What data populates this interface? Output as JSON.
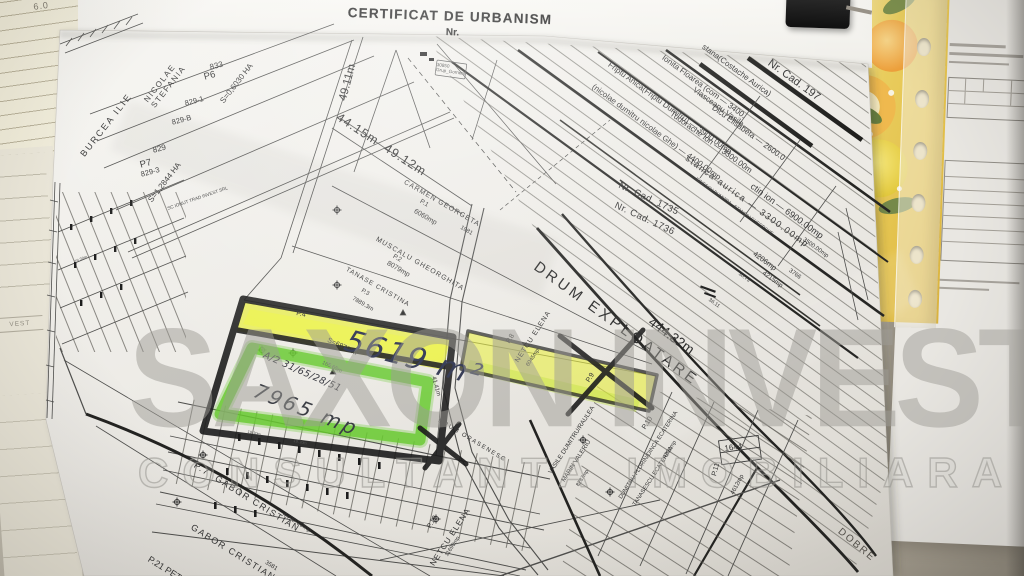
{
  "header": {
    "title": "CERTIFICAT DE URBANISM",
    "number_label": "Nr."
  },
  "watermark": {
    "line1": "SAXON INVEST",
    "line2": "CONSULTANTA IMOBILIARA"
  },
  "desk_notes": {
    "notebook_line1": "10. - 2016",
    "notebook_line2": "6.0",
    "underlay_label": "VEST"
  },
  "handwriting": {
    "area_highlight": "5619 m²",
    "area_parcel": "7965 mp",
    "cad_note": "A/2 31/65/28/51"
  },
  "colors": {
    "highlight_yellow": "#e7ee3b",
    "highlight_green": "#66c92e",
    "marker_black": "#1c1c1c",
    "folder_yellow": "#e6c84e",
    "ink_blue": "#2f3550",
    "paper": "#ece9e3"
  },
  "labels": [
    {
      "t": "NICOLAE\nSTEFANIA"
    },
    {
      "t": "833"
    },
    {
      "t": "P6"
    },
    {
      "t": "S=0,6030 HA"
    },
    {
      "t": "829-1"
    },
    {
      "t": "829-B"
    },
    {
      "t": "BURCEA ILIE"
    },
    {
      "t": "829"
    },
    {
      "t": "P7"
    },
    {
      "t": "829-3"
    },
    {
      "t": "S=1,2844 HA"
    },
    {
      "t": "SC IONUT TRAD INVEST SRL"
    },
    {
      "t": "49.11m"
    },
    {
      "t": "44.15m  49.12m"
    },
    {
      "t": "CARMEN GEORGETA"
    },
    {
      "t": "P.1"
    },
    {
      "t": "6060mp"
    },
    {
      "t": "1981"
    },
    {
      "t": "MUSCALU GHEORGHITA"
    },
    {
      "t": "P.2"
    },
    {
      "t": "8079mp"
    },
    {
      "t": "TANASE CRISTINA"
    },
    {
      "t": "P.3"
    },
    {
      "t": "7889.3m"
    },
    {
      "t": "P.4"
    },
    {
      "t": "S=6870MP"
    },
    {
      "t": "165.65m"
    },
    {
      "t": "41.41m"
    },
    {
      "t": "DRUM ORASENESC"
    },
    {
      "t": "P.8"
    },
    {
      "t": "NETCU ELENA"
    },
    {
      "t": "6045mp"
    },
    {
      "t": "DRUM EXPLOATARE"
    },
    {
      "t": "444.32m"
    },
    {
      "t": "P.9"
    },
    {
      "t": "VASILE DUMITRU/RAULEA"
    },
    {
      "t": "MARIN VALERIU"
    },
    {
      "t": "8287mp"
    },
    {
      "t": "Nr. Cad. 197"
    },
    {
      "t": "stana(Costache Aurica)"
    },
    {
      "t": "Ionita Floarea (com — 3400."
    },
    {
      "t": "Vlasceanu Vasile —"
    },
    {
      "t": "Dicu Elisabeta — 2600.0"
    },
    {
      "t": "Tudorache Ion — 3300.00m"
    },
    {
      "t": "Friptu Anica(Friptu Dumitru) — 3900.00mp"
    },
    {
      "t": "(nicolae dumitru nicolae Ghe) — 4400.00mp"
    },
    {
      "t": "stanca aurica — 3300.00mp"
    },
    {
      "t": "ctin ion — 6900.00mp"
    },
    {
      "t": "Nr. Cad. 1735"
    },
    {
      "t": "Nr. Cad. 1736"
    },
    {
      "t": "IONESCU DUMITRA · STANCIU GHEORGHE"
    },
    {
      "t": "3500.00mp"
    },
    {
      "t": "4206mp"
    },
    {
      "t": "4215mp"
    },
    {
      "t": "3766"
    },
    {
      "t": "30.73"
    },
    {
      "t": "36.11"
    },
    {
      "t": "P.10"
    },
    {
      "t": "DUMITRU FLORIN/DINCA ECATERINA"
    },
    {
      "t": "TANASESCU ECATERINA"
    },
    {
      "t": "4200mp"
    },
    {
      "t": "1644"
    },
    {
      "t": "P.11"
    },
    {
      "t": "4612mp"
    },
    {
      "t": "P.19"
    },
    {
      "t": "NETCU ELENA"
    },
    {
      "t": "11690mp"
    },
    {
      "t": "P.7  GABOR CRISTIAN"
    },
    {
      "t": "4499.00mp"
    },
    {
      "t": "GABOR CRISTIAN"
    },
    {
      "t": "3581"
    },
    {
      "t": "P.21 PET"
    },
    {
      "t": "DOBRE"
    },
    {
      "t": "30850\nGrup_Gorneni"
    },
    {
      "t": "19.30m"
    }
  ]
}
